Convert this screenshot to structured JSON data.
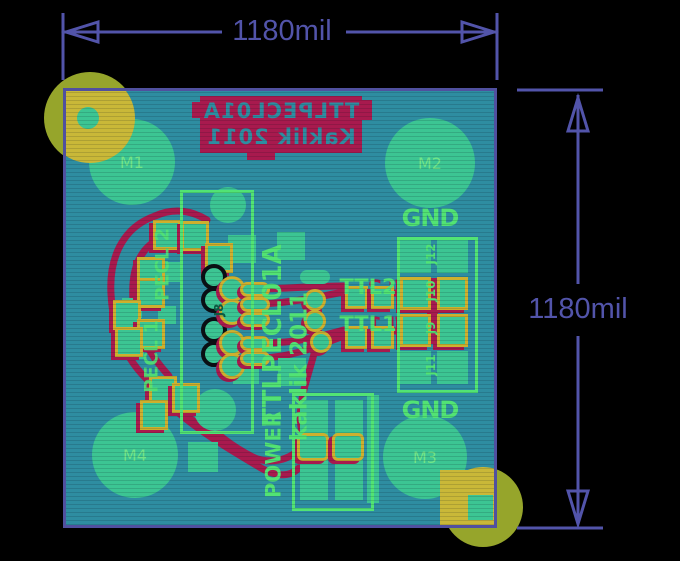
{
  "dimensions": {
    "horizontal": "1180mil",
    "vertical": "1180mil"
  },
  "silk_back": {
    "line1": "TTLPECL01A",
    "line2": "Kaklik 2011"
  },
  "silk_front": {
    "title": "TTLPECL01A",
    "credit": "kaklik 2011",
    "power": "POWER",
    "gnd_top": "GND",
    "gnd_bottom": "GND",
    "pecl1": "PECL 1",
    "pecl2": "PECL 2",
    "ttl1": "TTL1",
    "ttl2": "TTL2",
    "j8": "J8"
  },
  "mounting_holes": [
    {
      "label": "M1"
    },
    {
      "label": "M2"
    },
    {
      "label": "M3"
    },
    {
      "label": "M4"
    }
  ],
  "connector_rows": [
    {
      "label": "J12"
    },
    {
      "label": "J10"
    },
    {
      "label": "J9"
    },
    {
      "label": "J11"
    }
  ],
  "colors": {
    "background": "#000000",
    "board": "#2e8da1",
    "dimension": "#5254aa",
    "silk_front": "#52e374",
    "silk_back": "#a81a4e",
    "copper_pad": "#3cc593",
    "pad_ring": "#ceb02e",
    "fiducial_inside": "#c9b838",
    "fiducial_outside": "#96a52b",
    "hole_ring": "#0a0f14",
    "hole_label": "#72e487"
  }
}
